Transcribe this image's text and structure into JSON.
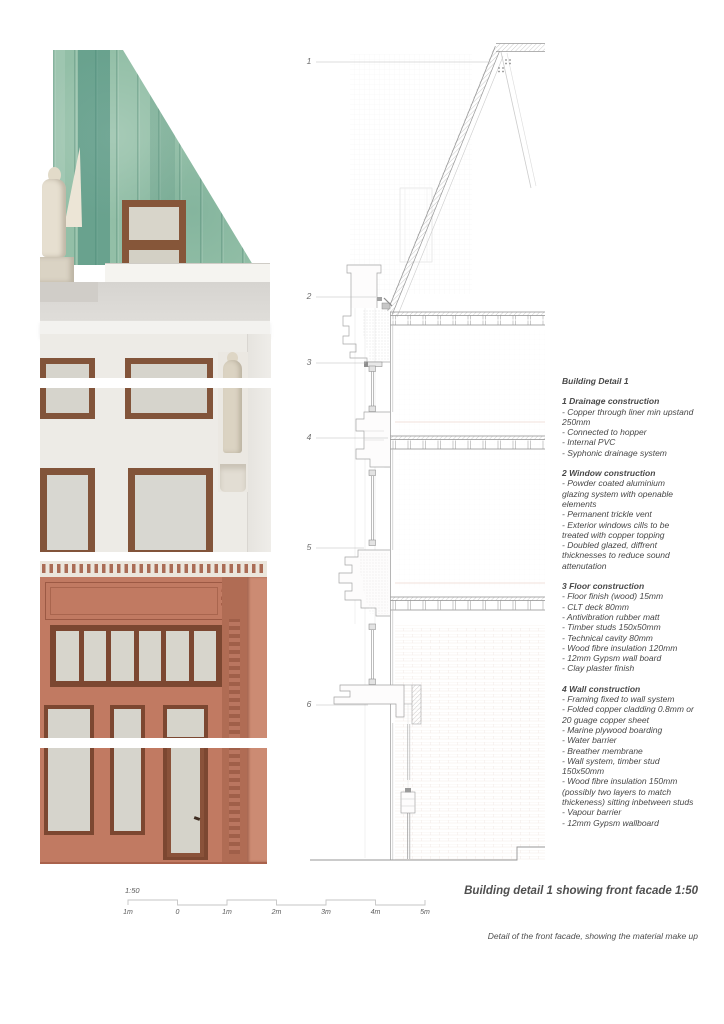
{
  "callouts": [
    "1",
    "2",
    "3",
    "4",
    "5",
    "6"
  ],
  "notes": {
    "title": "Building Detail 1",
    "sections": [
      {
        "heading": "1 Drainage construction",
        "items": [
          "- Copper through liner min upstand 250mm",
          "- Connected to hopper",
          "- Internal PVC",
          "- Syphonic drainage system"
        ]
      },
      {
        "heading": "2 Window construction",
        "items": [
          "- Powder coated aluminium glazing system with openable elements",
          "- Permanent trickle vent",
          "- Exterior windows cills to be treated with copper topping",
          "- Doubled glazed, diffrent thicknesses to reduce sound attenutation"
        ]
      },
      {
        "heading": "3 Floor construction",
        "items": [
          "- Floor finish (wood) 15mm",
          "- CLT deck 80mm",
          "- Antivibration rubber matt",
          "- Timber studs 150x50mm",
          "- Technical cavity 80mm",
          "- Wood fibre insulation 120mm",
          "- 12mm Gypsm wall board",
          "- Clay plaster finish"
        ]
      },
      {
        "heading": "4 Wall construction",
        "items": [
          "- Framing fixed to wall system",
          "- Folded copper cladding 0.8mm or 20 guage copper sheet",
          "- Marine plywood boarding",
          "- Water barrier",
          "- Breather membrane",
          "- Wall system, timber stud 150x50mm",
          "- Wood fibre insulation 150mm (possibly two layers to match thickeness) sitting inbetween studs",
          "- Vapour barrier",
          "- 12mm Gypsm wallboard"
        ]
      }
    ]
  },
  "scalebar": {
    "ratio": "1:50",
    "labels": [
      "1m",
      "0",
      "1m",
      "2m",
      "3m",
      "4m",
      "5m"
    ]
  },
  "captions": {
    "title": "Building detail 1 showing front facade 1:50",
    "subtitle": "Detail of the front facade, showing the material make up"
  },
  "colors": {
    "copper_green": "#93bfa7",
    "copper_seam_dark": "#3f8575",
    "stone_white": "#edebe6",
    "window_frame_brown": "#82543a",
    "shopfront_terracotta": "#c17a62",
    "shopfront_dark_frame": "#7c4731",
    "glass": "#d6d4cc",
    "statue_cream": "#e6dfd0",
    "drawing_line": "#9a9a9a",
    "text": "#474747"
  }
}
